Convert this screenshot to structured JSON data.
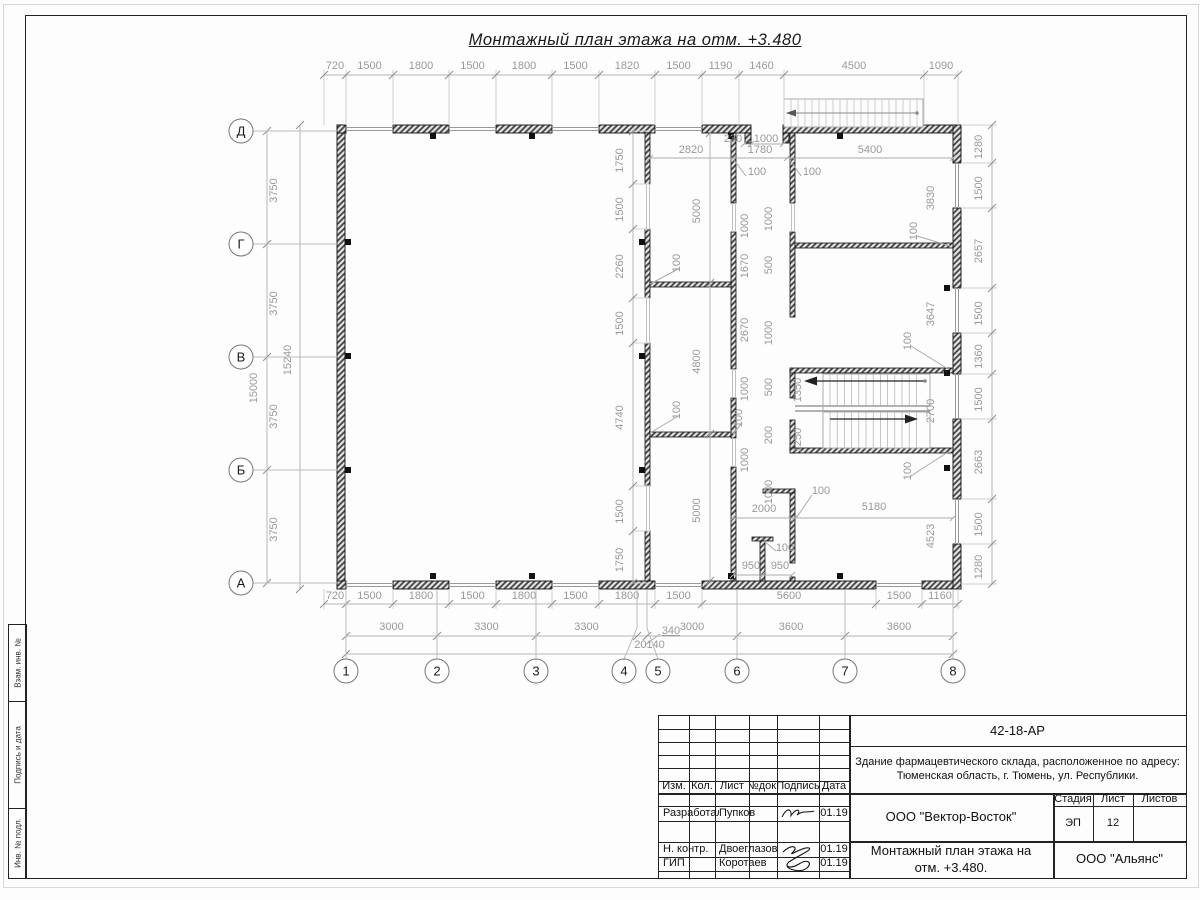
{
  "title": "Монтажный план этажа на отм. +3.480",
  "colors": {
    "line": "#1a1a1a",
    "dim": "#999999",
    "wall_hatch": "#3a3a3a",
    "stair": "#aaaaaa"
  },
  "grid": {
    "cols": [
      {
        "label": "1",
        "cx": 346,
        "lx": 346
      },
      {
        "label": "2",
        "cx": 437,
        "lx": 437
      },
      {
        "label": "3",
        "cx": 536,
        "lx": 536
      },
      {
        "label": "4",
        "cx": 624,
        "lx": 637
      },
      {
        "label": "5",
        "cx": 658,
        "lx": 647
      },
      {
        "label": "6",
        "cx": 737,
        "lx": 737
      },
      {
        "label": "7",
        "cx": 845,
        "lx": 845
      },
      {
        "label": "8",
        "cx": 953,
        "lx": 953
      }
    ],
    "rows": [
      {
        "label": "Д",
        "y": 131
      },
      {
        "label": "Г",
        "y": 244
      },
      {
        "label": "В",
        "y": 357
      },
      {
        "label": "Б",
        "y": 470
      },
      {
        "label": "А",
        "y": 583
      }
    ]
  },
  "dims": {
    "chains": [
      {
        "name": "top",
        "vert": false,
        "pos": 75,
        "label_off": 69,
        "ticks": [
          324,
          346,
          393,
          449,
          496,
          552,
          599,
          655,
          702,
          739,
          784,
          924,
          958
        ],
        "labels": [
          "720",
          "1500",
          "1800",
          "1500",
          "1800",
          "1500",
          "1820",
          "1500",
          "1190",
          "1460",
          "4500",
          "1090"
        ],
        "ext": [
          70,
          125
        ]
      },
      {
        "name": "bottom-1",
        "vert": false,
        "pos": 604,
        "label_off": 599,
        "ticks": [
          324,
          346,
          393,
          449,
          496,
          552,
          599,
          655,
          702,
          876,
          922,
          958
        ],
        "labels": [
          "720",
          "1500",
          "1800",
          "1500",
          "1800",
          "1500",
          "1800",
          "1500",
          "5600",
          "1500",
          "1160"
        ],
        "ext": [
          589,
          609
        ]
      },
      {
        "name": "bottom-2",
        "vert": false,
        "pos": 636,
        "label_off": 630,
        "ticks": [
          346,
          437,
          536,
          637,
          647,
          737,
          845,
          953
        ],
        "labels": [
          "3000",
          "3300",
          "3300",
          "",
          "3000",
          "3600",
          "3600"
        ]
      },
      {
        "name": "bottom-total",
        "vert": false,
        "pos": 654,
        "label_off": 648,
        "ticks": [
          346,
          953
        ],
        "labels": [
          "20140"
        ]
      },
      {
        "name": "right",
        "vert": true,
        "pos": 992,
        "label_off": 982,
        "ticks": [
          125,
          163,
          208,
          288,
          333,
          374,
          419,
          499,
          544,
          584
        ],
        "labels": [
          "1280",
          "1500",
          "2657",
          "1500",
          "1360",
          "1500",
          "2663",
          "1500",
          "1280"
        ],
        "ext": [
          961,
          997
        ]
      },
      {
        "name": "left-spans",
        "vert": true,
        "pos": 267,
        "label_off": 277,
        "ticks": [
          131,
          244,
          357,
          470,
          583
        ],
        "labels": [
          "3750",
          "3750",
          "3750",
          "3750"
        ]
      },
      {
        "name": "left-outer",
        "vert": true,
        "pos": 300,
        "label_off": 291,
        "ticks": [
          125,
          589
        ],
        "labels": [
          "15240"
        ]
      },
      {
        "name": "mid-wall-openings",
        "vert": true,
        "pos": 633,
        "label_off": 623,
        "ticks": [
          131,
          184,
          229,
          298,
          343,
          486,
          531,
          583
        ],
        "labels": [
          "1750",
          "1500",
          "2260",
          "1500",
          "4740",
          "1500",
          "1750"
        ],
        "ext": [
          633,
          650
        ]
      },
      {
        "name": "mid-rooms",
        "vert": true,
        "pos": 710,
        "label_off": 700,
        "ticks": [
          133,
          283,
          434,
          581
        ],
        "labels": [
          "5000",
          "4800",
          "5000"
        ]
      }
    ],
    "labels": [
      {
        "t": "2820",
        "x": 691,
        "y": 150,
        "r": 0
      },
      {
        "t": "1780",
        "x": 760,
        "y": 150,
        "r": 0
      },
      {
        "t": "5400",
        "x": 870,
        "y": 150,
        "r": 0
      },
      {
        "t": "100",
        "x": 757,
        "y": 172,
        "r": 0
      },
      {
        "t": "100",
        "x": 812,
        "y": 172,
        "r": 0
      },
      {
        "t": "230",
        "x": 733,
        "y": 139,
        "r": 0
      },
      {
        "t": "1000",
        "x": 766,
        "y": 139,
        "r": 0
      },
      {
        "t": "1000",
        "x": 748,
        "y": 223,
        "r": -90
      },
      {
        "t": "1000",
        "x": 772,
        "y": 216,
        "r": -90
      },
      {
        "t": "1670",
        "x": 748,
        "y": 263,
        "r": -90
      },
      {
        "t": "500",
        "x": 772,
        "y": 262,
        "r": -90
      },
      {
        "t": "2670",
        "x": 748,
        "y": 327,
        "r": -90
      },
      {
        "t": "1000",
        "x": 772,
        "y": 330,
        "r": -90
      },
      {
        "t": "500",
        "x": 772,
        "y": 384,
        "r": -90
      },
      {
        "t": "1000",
        "x": 748,
        "y": 386,
        "r": -90
      },
      {
        "t": "1350",
        "x": 801,
        "y": 387,
        "r": -90
      },
      {
        "t": "1250",
        "x": 801,
        "y": 437,
        "r": -90
      },
      {
        "t": "200",
        "x": 772,
        "y": 432,
        "r": -90
      },
      {
        "t": "1000",
        "x": 748,
        "y": 457,
        "r": -90
      },
      {
        "t": "1000",
        "x": 772,
        "y": 489,
        "r": -90
      },
      {
        "t": "100",
        "x": 742,
        "y": 415,
        "r": -90
      },
      {
        "t": "100",
        "x": 680,
        "y": 260,
        "r": -90
      },
      {
        "t": "100",
        "x": 680,
        "y": 407,
        "r": -90
      },
      {
        "t": "3830",
        "x": 934,
        "y": 195,
        "r": -90
      },
      {
        "t": "100",
        "x": 917,
        "y": 228,
        "r": -90
      },
      {
        "t": "3647",
        "x": 934,
        "y": 311,
        "r": -90
      },
      {
        "t": "100",
        "x": 911,
        "y": 338,
        "r": -90
      },
      {
        "t": "2700",
        "x": 934,
        "y": 408,
        "r": -90
      },
      {
        "t": "100",
        "x": 911,
        "y": 468,
        "r": -90
      },
      {
        "t": "4523",
        "x": 934,
        "y": 533,
        "r": -90
      },
      {
        "t": "15000",
        "x": 257,
        "y": 385,
        "r": -90
      },
      {
        "t": "2000",
        "x": 764,
        "y": 509,
        "r": 0
      },
      {
        "t": "5180",
        "x": 874,
        "y": 507,
        "r": 0
      },
      {
        "t": "100",
        "x": 821,
        "y": 491,
        "r": 0
      },
      {
        "t": "100",
        "x": 785,
        "y": 548,
        "r": 0
      },
      {
        "t": "950",
        "x": 751,
        "y": 566,
        "r": 0
      },
      {
        "t": "950",
        "x": 780,
        "y": 566,
        "r": 0
      },
      {
        "t": "340",
        "x": 671,
        "y": 631,
        "r": 0,
        "u": true
      }
    ]
  },
  "titleblock": {
    "doc_number": "42-18-АР",
    "description_line1": "Здание фармацевтического склада, расположенное по адресу:",
    "description_line2": "Тюменская область, г. Тюмень, ул. Республики.",
    "company": "ООО \"Вектор-Восток\"",
    "stage_label": "Стадия",
    "sheet_label": "Лист",
    "sheets_label": "Листов",
    "stage": "ЭП",
    "sheet": "12",
    "sheets": "",
    "drawing_title_line1": "Монтажный план этажа на",
    "drawing_title_line2": "отм. +3.480.",
    "org": "ООО \"Альянс\"",
    "header": {
      "izm": "Изм.",
      "kol": "Кол.",
      "list": "Лист",
      "ndok": "№док.",
      "podpis": "Подпись",
      "data": "Дата"
    },
    "roles": [
      {
        "role": "Разработал",
        "name": "Пупков",
        "date": "01.19"
      },
      {
        "role": "Н. контр.",
        "name": "Двоеглазов",
        "date": "01.19"
      },
      {
        "role": "ГИП",
        "name": "Коротаев",
        "date": "01.19"
      }
    ]
  },
  "side_stamp": {
    "cell1": "Взам. инв. №",
    "cell2": "Подпись и дата",
    "cell3": "Инв. № подл."
  }
}
